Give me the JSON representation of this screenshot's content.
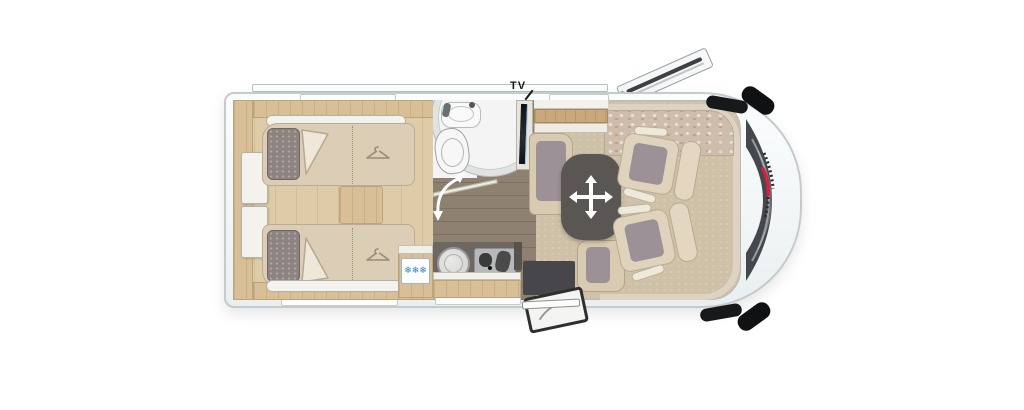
{
  "diagram": {
    "type": "motorhome floorplan, top view",
    "labels": {
      "tv": "TV"
    },
    "icons": {
      "fridge_snowflakes": "❄❄❄",
      "wardrobe_hanger": "hanger-icon",
      "table_move_arrow": "four-way-arrow-icon",
      "bathroom_door_swing": "curved-double-arrow-icon",
      "brand_logo": "red-swoosh-emblem"
    },
    "colors": {
      "body_white": "#f8fbfb",
      "outline_gray": "#c5cacc",
      "bedroom_wood_floor": "#decca8",
      "hallway_wood_floor": "#8e8172",
      "lounge_carpet": "#cfc1a8",
      "furniture_wood": "#d8bf97",
      "upholstery_beige": "#dccdb6",
      "cushion_gray": "#9b9197",
      "table_gray": "#595654",
      "snowflake_blue": "#2f7fc0",
      "brand_red": "#d5203e",
      "windshield_dark": "#44474b"
    }
  }
}
